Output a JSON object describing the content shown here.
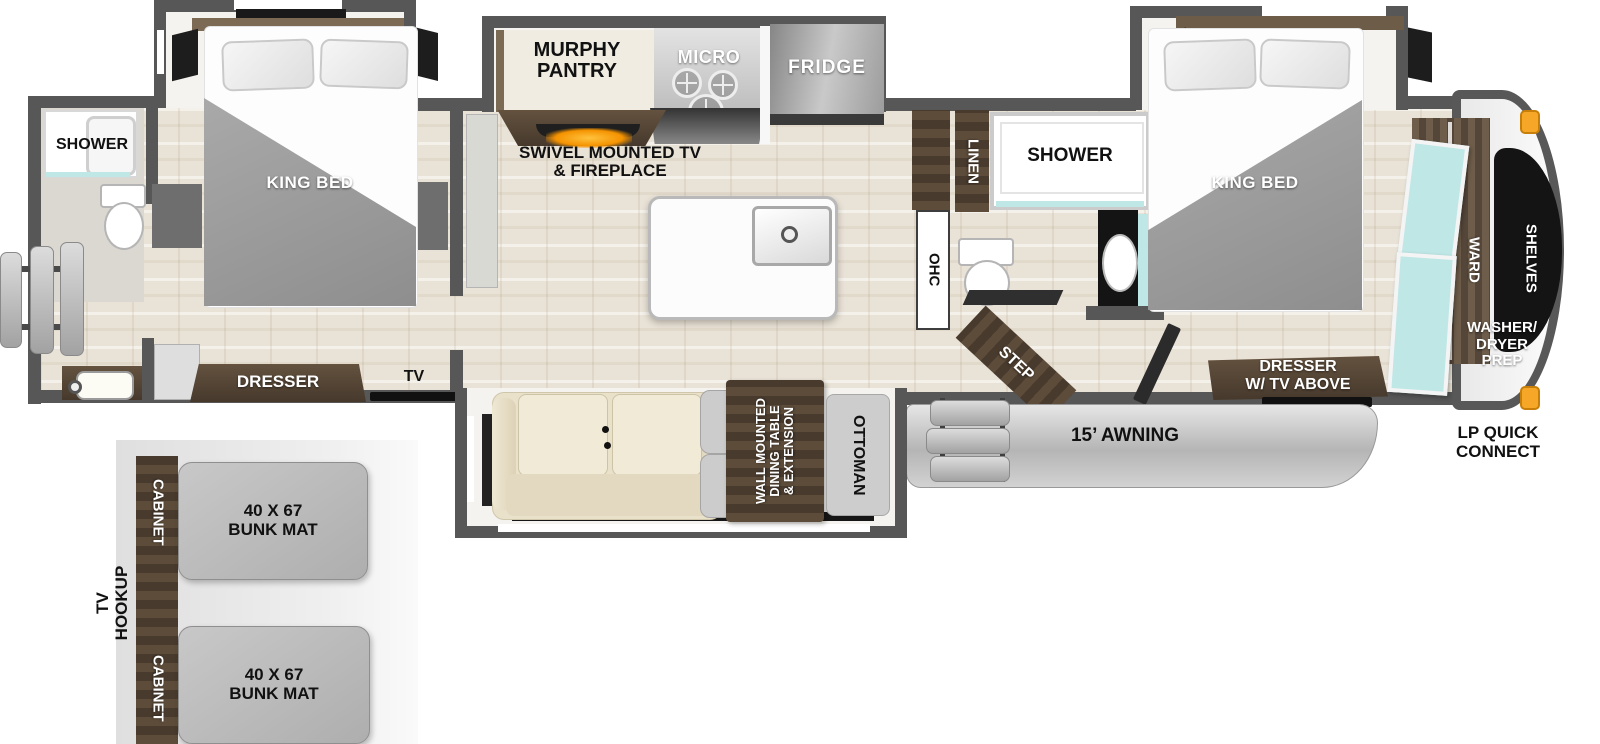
{
  "plan": {
    "rear_bath": {
      "shower": "SHOWER"
    },
    "rear_bedroom": {
      "king_bed": "KING BED",
      "dresser": "DRESSER",
      "tv": "TV"
    },
    "kitchen": {
      "murphy_l1": "MURPHY",
      "murphy_l2": "PANTRY",
      "micro": "MICRO",
      "fridge": "FRIDGE",
      "swivel_l1": "SWIVEL MOUNTED TV",
      "swivel_l2": "& FIREPLACE"
    },
    "mid_bath": {
      "linen": "LINEN",
      "shower": "SHOWER",
      "ohc": "OHC",
      "step": "STEP"
    },
    "living": {
      "table_l1": "WALL MOUNTED",
      "table_l2": "DINING TABLE",
      "table_l3": "& EXTENSION",
      "ottoman": "OTTOMAN"
    },
    "front_bedroom": {
      "king_bed": "KING BED",
      "dresser_l1": "DRESSER",
      "dresser_l2": "W/ TV ABOVE"
    },
    "front_closet": {
      "ward": "WARD",
      "shelves": "SHELVES",
      "washer_l1": "WASHER/",
      "washer_l2": "DRYER",
      "washer_l3": "PREP",
      "lp_l1": "LP QUICK",
      "lp_l2": "CONNECT"
    },
    "exterior": {
      "awning": "15’ AWNING"
    },
    "bunk": {
      "tv_l1": "TV",
      "tv_l2": "HOOKUP",
      "cabinet_top": "CABINET",
      "cabinet_bottom": "CABINET",
      "mat1_l1": "40 X 67",
      "mat1_l2": "BUNK MAT",
      "mat2_l1": "40 X 67",
      "mat2_l2": "BUNK MAT"
    }
  },
  "colors": {
    "wall": "#575757",
    "wood_dark": "#4a3c31",
    "floor": "#e9e2d6",
    "teal": "#bfe7e6",
    "accent_orange": "#f2a233",
    "blanket_gray": "#9b9b9b"
  }
}
